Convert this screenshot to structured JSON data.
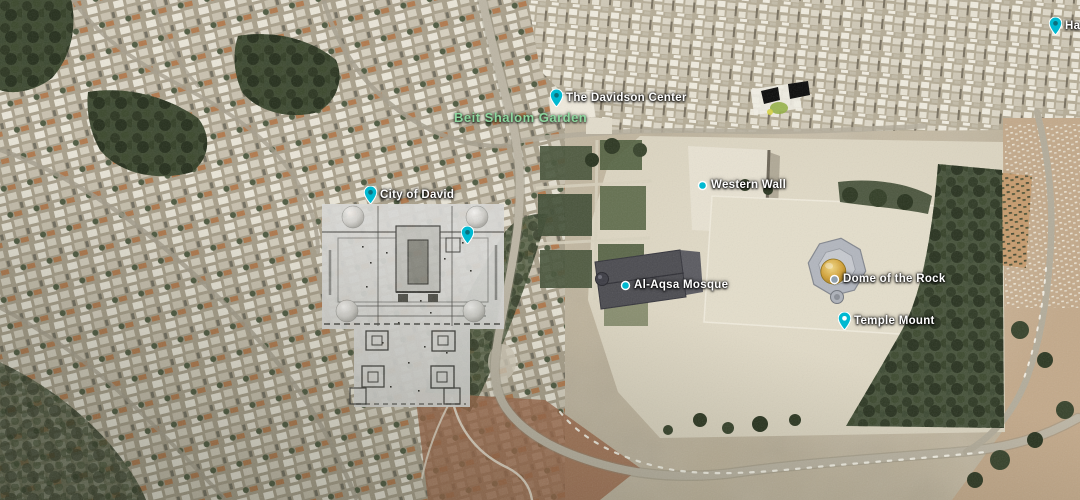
{
  "labels": {
    "davidson_center": "The Davidson Center",
    "beit_shalom_garden": "Beit Shalom Garden",
    "city_of_david": "City of David",
    "western_wall": "Western Wall",
    "al_aqsa_mosque": "Al-Aqsa Mosque",
    "dome_of_the_rock": "Dome of the Rock",
    "temple_mount": "Temple Mount",
    "edge_clipped_label": "Ha"
  },
  "icons": {
    "teardrop_pin": "teal teardrop map pin",
    "dot_pin": "teal circle map pin"
  },
  "colors": {
    "pin_teal": "#00b9d1",
    "label_text": "#ffffff",
    "park_label_green": "#8ed89f",
    "dome_gold": "#d2a137",
    "annotation_black": "#0a0a0a",
    "overlay_plan_gray": "#d9d9d6"
  }
}
